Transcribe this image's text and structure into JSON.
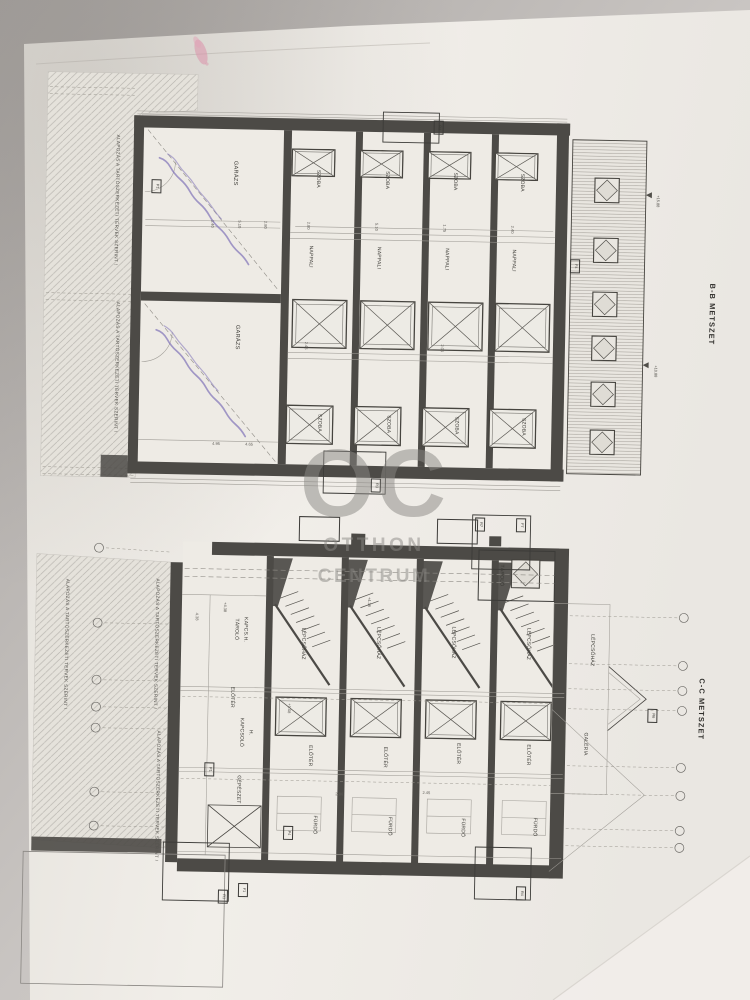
{
  "colors": {
    "paper": "#efece7",
    "background": "#c6c2bf",
    "ink": "#45433f",
    "wall_fill": "#4c4a46",
    "hatch": "#b7b4ae",
    "watermark_gray": "#8a8884",
    "stamp_purple": "#7f72b8",
    "pink_mark": "#da92a9"
  },
  "watermark": {
    "monogram": "OC",
    "word1": "OTTHON",
    "word2": "CENTRUM"
  },
  "foundation_note": "ALAPOZÁS A TARTÓSZERKEZETI TERVEK SZERINT !",
  "upper": {
    "title": "B-B METSZET",
    "garage": "GARÁZS",
    "bedroom": "SZOBA",
    "living": "NAPPALI",
    "levels": {
      "ridge": "+15.88",
      "eave": "+10.88"
    },
    "tags": {
      "p1": "P1",
      "r2": "R2",
      "r3": "R3",
      "f4": "F4"
    }
  },
  "lower": {
    "title": "C-C METSZET",
    "stair": "LÉPCSŐHÁZ",
    "foyer": "ELŐTÉR",
    "bath": "FÜRDŐ",
    "storage": "TÁROLÓ",
    "storage_line1": "TÁROLÓ",
    "storage_line2": "KAPCS.H.",
    "switch_line1": "KAPCSOLÓ",
    "switch_line2": "H.",
    "mechanical": "GÉPÉSZET",
    "gallery": "GALÉRIA",
    "levels": {
      "a": "+4.38",
      "b": "+1.08"
    },
    "tags": {
      "r1": "R1",
      "f1": "F1",
      "r4": "R4",
      "r6": "R6",
      "r7": "R7",
      "f7": "F7",
      "p1": "P1",
      "p4": "P4"
    }
  },
  "dims": {
    "d280": "2.80",
    "d510": "5.10",
    "d175": "1.75",
    "d240": "2.40",
    "d245": "2.45",
    "d205": "2.05",
    "d495": "4.95",
    "d465": "4.65",
    "d140": "1.40",
    "d438": "4.38"
  }
}
